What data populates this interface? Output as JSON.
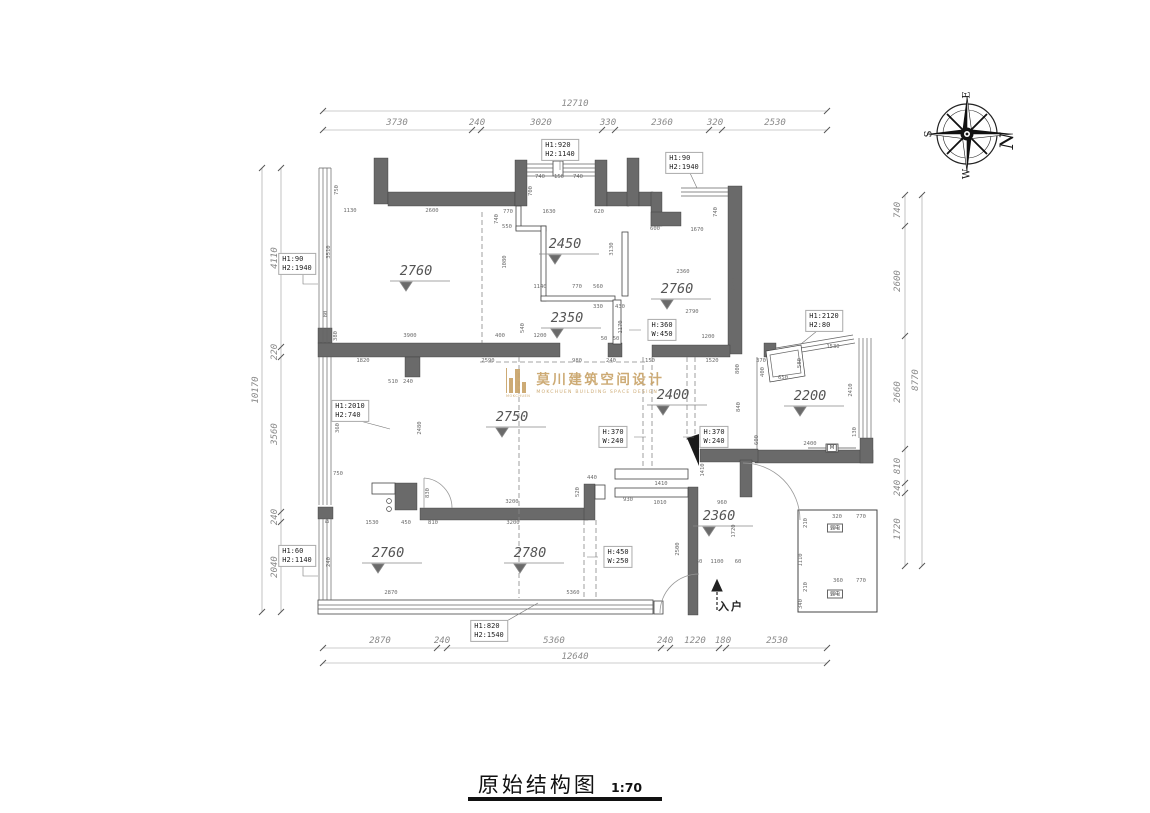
{
  "title": {
    "main": "原始结构图",
    "scale": "1:70"
  },
  "compass": {
    "top": "E",
    "left": "S",
    "bottom": "W",
    "right": "N"
  },
  "watermark": {
    "cn": "莫川建筑空间设计",
    "en": "MOKCHUEN BUILDING SPACE DESIGN",
    "caption": "MOKCHUEN",
    "color": "#c9a46a"
  },
  "entrance": "入户",
  "marks": {
    "m": "M",
    "weak": "弱电"
  },
  "colors": {
    "wall": "#6a6a6a",
    "gold": "#c9a46a"
  },
  "chains": {
    "top": {
      "total": "12710",
      "segs": [
        "3730",
        "240",
        "3020",
        "330",
        "2360",
        "320",
        "2530"
      ]
    },
    "bottom": {
      "total": "12640",
      "segs": [
        "2870",
        "240",
        "5360",
        "240",
        "1220",
        "180",
        "2530"
      ]
    },
    "left": {
      "total": "10170",
      "segs": [
        "4110",
        "220",
        "3560",
        "240",
        "2040"
      ]
    },
    "right": {
      "total": "8770",
      "segs": [
        "740",
        "2600",
        "2660",
        "810",
        "240",
        "1720"
      ]
    }
  },
  "levels": {
    "tl": "2760",
    "mt": "2450",
    "tr": "2760",
    "mid": "2350",
    "living": "2750",
    "hall": "2400",
    "bay": "2200",
    "bl": "2760",
    "bm": "2780",
    "entry": "2360"
  },
  "boxes": {
    "b1": [
      "H1:920",
      "H2:1140"
    ],
    "b2": [
      "H1:90",
      "H2:1940"
    ],
    "b3": [
      "H1:90",
      "H2:1940"
    ],
    "b4": [
      "H1:2120",
      "H2:80"
    ],
    "b5": [
      "H1:2010",
      "H2:740"
    ],
    "b6": [
      "H:360",
      "W:450"
    ],
    "b7": [
      "H:370",
      "W:240"
    ],
    "b8": [
      "H:370",
      "W:240"
    ],
    "b9": [
      "H:450",
      "W:250"
    ],
    "b10": [
      "H1:60",
      "H2:1140"
    ],
    "b11": [
      "H1:820",
      "H2:1540"
    ]
  },
  "d": [
    "750",
    "1130",
    "2600",
    "3510",
    "80",
    "380",
    "740",
    "150",
    "740",
    "700",
    "770",
    "1630",
    "620",
    "550",
    "740",
    "3130",
    "1080",
    "1140",
    "770",
    "560",
    "330",
    "430",
    "1170",
    "540",
    "400",
    "1200",
    "50",
    "50",
    "2590",
    "980",
    "240",
    "150",
    "740",
    "600",
    "1670",
    "2360",
    "2780",
    "2790",
    "1200",
    "1520",
    "370",
    "1530",
    "400",
    "650",
    "580",
    "2410",
    "2400",
    "130",
    "800",
    "840",
    "600",
    "1410",
    "1410",
    "960",
    "1010",
    "2500",
    "1720",
    "60",
    "1100",
    "60",
    "510",
    "240",
    "2480",
    "360",
    "750",
    "830",
    "3900",
    "1820",
    "1530",
    "450",
    "810",
    "3200",
    "3200",
    "520",
    "440",
    "930",
    "80",
    "240",
    "2870",
    "5360",
    "320",
    "770",
    "210",
    "1110",
    "360",
    "770",
    "210",
    "340"
  ]
}
